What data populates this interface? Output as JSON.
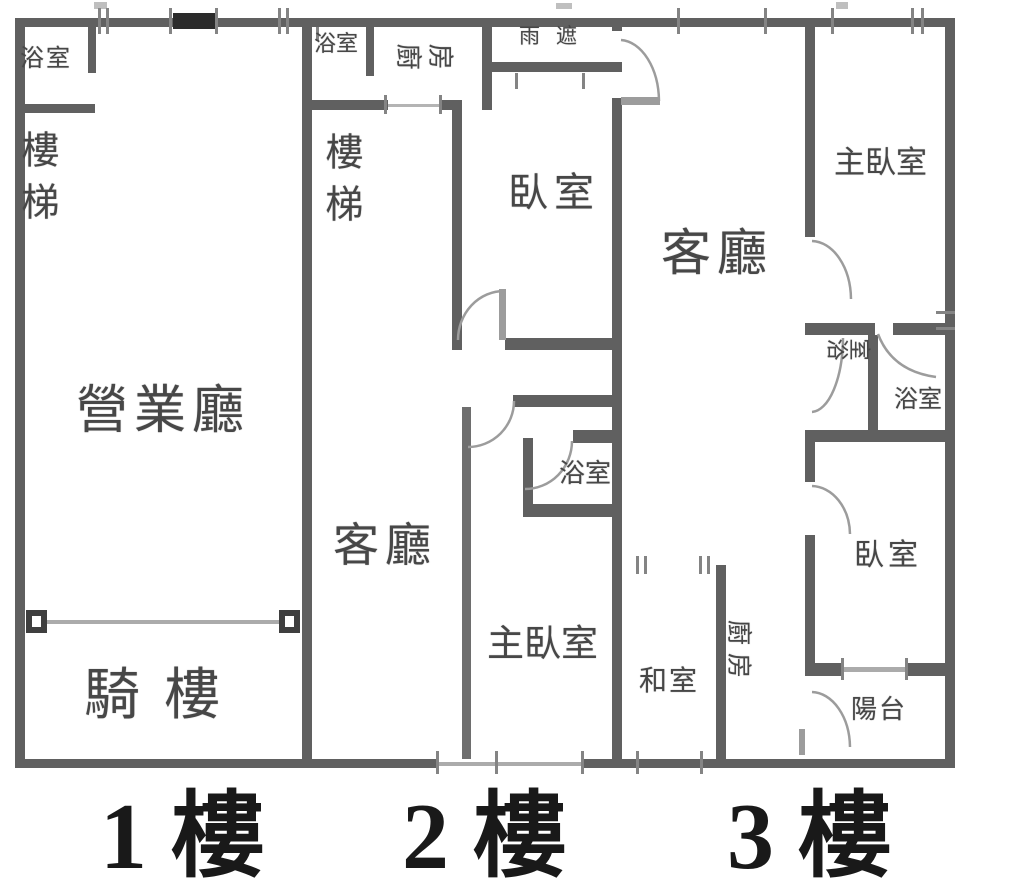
{
  "floorplan": {
    "floors": {
      "f1": {
        "caption": "1 樓",
        "rooms": {
          "bathroom": "浴室",
          "stairs": "樓梯",
          "business_hall": "營業廳",
          "arcade": "騎樓"
        }
      },
      "f2": {
        "caption": "2 樓",
        "rooms": {
          "bathroom_top": "浴室",
          "kitchen": "廚房",
          "rain_canopy": "雨遮",
          "stairs": "樓梯",
          "bedroom": "臥室",
          "living_room": "客廳",
          "bathroom": "浴室",
          "master_bedroom": "主臥室"
        }
      },
      "f3": {
        "caption": "3 樓",
        "rooms": {
          "living_room": "客廳",
          "master_bedroom": "主臥室",
          "bathroom_left": "浴室",
          "bathroom_right": "浴室",
          "bedroom": "臥室",
          "tatami_room": "和室",
          "kitchen": "廚房",
          "balcony": "陽台"
        }
      }
    },
    "colors": {
      "wall": "#606060",
      "thin_line": "#ababab",
      "window_bar": "#2b2b2b",
      "door_arc": "#9c9c9c",
      "label_text": "#474747",
      "caption_text": "#191919",
      "background": "#ffffff"
    }
  }
}
